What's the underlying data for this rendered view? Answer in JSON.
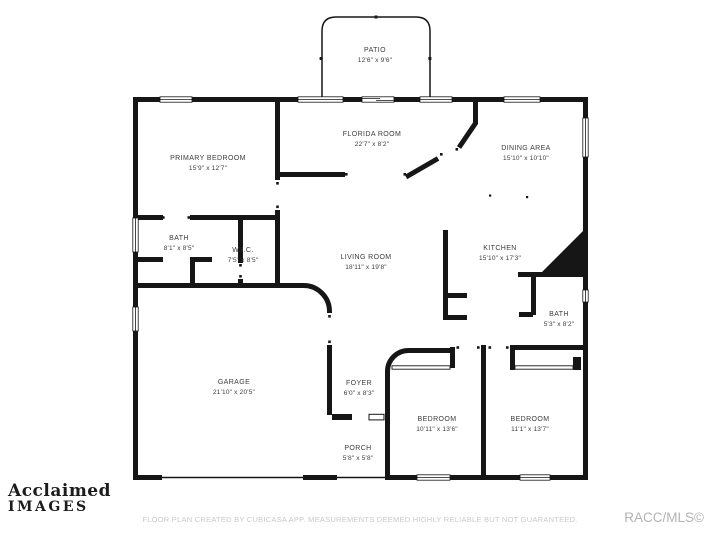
{
  "meta": {
    "type": "floor-plan",
    "background_color": "#ffffff",
    "wall_color": "#161616",
    "label_color": "#3c3c3c",
    "disclaimer_color": "#c9c9c9",
    "credit_color": "#b3b3b3"
  },
  "plan": {
    "rooms": [
      {
        "id": "patio",
        "name": "PATIO",
        "dims": "12'6\" x 9'6\""
      },
      {
        "id": "florida-room",
        "name": "FLORIDA ROOM",
        "dims": "22'7\" x 8'2\""
      },
      {
        "id": "dining-area",
        "name": "DINING AREA",
        "dims": "15'10\" x 10'10\""
      },
      {
        "id": "primary-bedroom",
        "name": "PRIMARY BEDROOM",
        "dims": "15'9\" x 12'7\""
      },
      {
        "id": "bath-primary",
        "name": "BATH",
        "dims": "8'1\" x 8'5\""
      },
      {
        "id": "wic",
        "name": "W.I.C.",
        "dims": "7'5\" x 8'5\""
      },
      {
        "id": "living-room",
        "name": "LIVING ROOM",
        "dims": "18'11\" x 19'8\""
      },
      {
        "id": "kitchen",
        "name": "KITCHEN",
        "dims": "15'10\" x 17'3\""
      },
      {
        "id": "bath-hall",
        "name": "BATH",
        "dims": "5'3\" x 8'2\""
      },
      {
        "id": "garage",
        "name": "GARAGE",
        "dims": "21'10\" x 20'5\""
      },
      {
        "id": "foyer",
        "name": "FOYER",
        "dims": "6'0\" x 8'3\""
      },
      {
        "id": "porch",
        "name": "PORCH",
        "dims": "5'8\" x 5'8\""
      },
      {
        "id": "bedroom-center",
        "name": "BEDROOM",
        "dims": "10'11\" x 13'6\""
      },
      {
        "id": "bedroom-right",
        "name": "BEDROOM",
        "dims": "11'1\" x 13'7\""
      }
    ]
  },
  "watermark": {
    "line1": "Acclaimed",
    "line2": "IMAGES"
  },
  "footer": {
    "disclaimer": "FLOOR PLAN CREATED BY CUBICASA APP. MEASUREMENTS DEEMED HIGHLY RELIABLE BUT NOT GUARANTEED.",
    "credit": "RACC/MLS©"
  }
}
